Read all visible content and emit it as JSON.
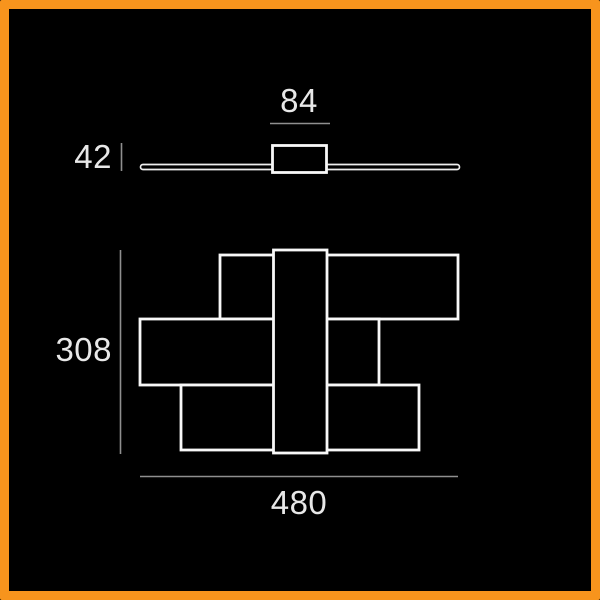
{
  "frame": {
    "border_color": "#F7941D",
    "background_color": "#000000"
  },
  "drawing": {
    "front_view": {
      "canopy_width_label": "84",
      "height_label": "42"
    },
    "plan_view": {
      "depth_label": "308",
      "width_label": "480"
    }
  },
  "colors": {
    "shape_outline": "#F8F8F8",
    "dimension_line": "#8F8F8F",
    "label_text": "#E8E8E8"
  }
}
